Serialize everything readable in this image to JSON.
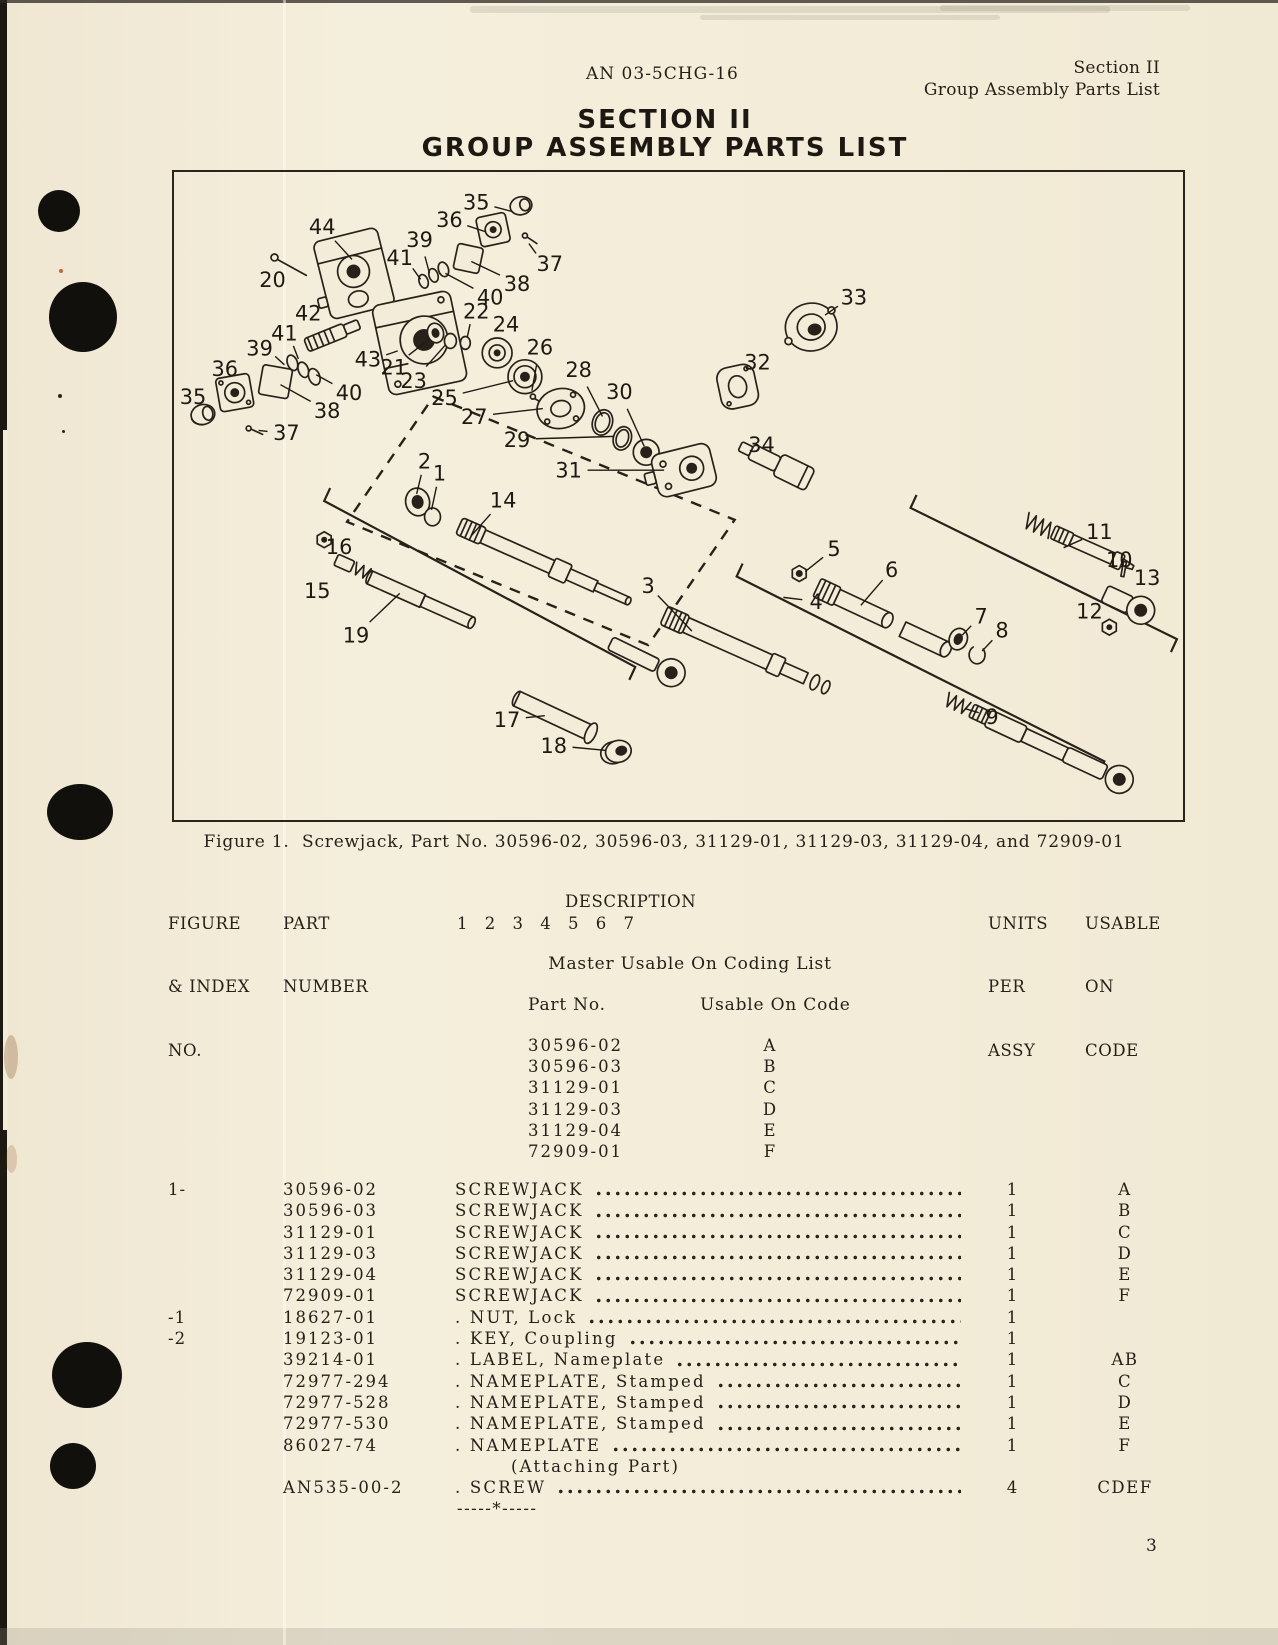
{
  "page": {
    "number": "3"
  },
  "header": {
    "doc_number": "AN 03-5CHG-16",
    "section": "Section II",
    "section_subtitle": "Group Assembly Parts List",
    "title_line1": "SECTION II",
    "title_line2": "GROUP ASSEMBLY PARTS LIST"
  },
  "figure": {
    "caption": "Figure 1.  Screwjack, Part No. 30596-02, 30596-03, 31129-01, 31129-03, 31129-04, and 72909-01",
    "callouts": [
      {
        "n": "35",
        "x": 303,
        "y": 30,
        "tx": 340,
        "ty": 40
      },
      {
        "n": "36",
        "x": 276,
        "y": 48,
        "tx": 312,
        "ty": 60
      },
      {
        "n": "44",
        "x": 148,
        "y": 55,
        "tx": 178,
        "ty": 88
      },
      {
        "n": "39",
        "x": 246,
        "y": 68,
        "tx": 256,
        "ty": 102
      },
      {
        "n": "41",
        "x": 226,
        "y": 86,
        "tx": 247,
        "ty": 108
      },
      {
        "n": "37",
        "x": 377,
        "y": 92,
        "tx": 356,
        "ty": 72
      },
      {
        "n": "20",
        "x": 98,
        "y": 108,
        "tx": 110,
        "ty": 94
      },
      {
        "n": "38",
        "x": 344,
        "y": 112,
        "tx": 298,
        "ty": 90
      },
      {
        "n": "40",
        "x": 317,
        "y": 126,
        "tx": 272,
        "ty": 102
      },
      {
        "n": "42",
        "x": 134,
        "y": 142,
        "tx": 150,
        "ty": 158
      },
      {
        "n": "22",
        "x": 303,
        "y": 140,
        "tx": 294,
        "ty": 166
      },
      {
        "n": "24",
        "x": 333,
        "y": 153,
        "tx": 327,
        "ty": 176
      },
      {
        "n": "41",
        "x": 110,
        "y": 162,
        "tx": 124,
        "ty": 188
      },
      {
        "n": "39",
        "x": 85,
        "y": 177,
        "tx": 110,
        "ty": 194
      },
      {
        "n": "26",
        "x": 367,
        "y": 176,
        "tx": 359,
        "ty": 220
      },
      {
        "n": "43",
        "x": 194,
        "y": 188,
        "tx": 224,
        "ty": 180
      },
      {
        "n": "21",
        "x": 220,
        "y": 196,
        "tx": 256,
        "ty": 168
      },
      {
        "n": "36",
        "x": 50,
        "y": 198,
        "tx": 58,
        "ty": 216
      },
      {
        "n": "28",
        "x": 406,
        "y": 199,
        "tx": 430,
        "ty": 246
      },
      {
        "n": "23",
        "x": 240,
        "y": 210,
        "tx": 272,
        "ty": 174
      },
      {
        "n": "40",
        "x": 175,
        "y": 222,
        "tx": 142,
        "ty": 204
      },
      {
        "n": "35",
        "x": 18,
        "y": 226,
        "tx": 27,
        "ty": 240
      },
      {
        "n": "25",
        "x": 271,
        "y": 227,
        "tx": 340,
        "ty": 210
      },
      {
        "n": "38",
        "x": 153,
        "y": 240,
        "tx": 106,
        "ty": 214
      },
      {
        "n": "27",
        "x": 301,
        "y": 246,
        "tx": 370,
        "ty": 238
      },
      {
        "n": "37",
        "x": 112,
        "y": 262,
        "tx": 84,
        "ty": 260
      },
      {
        "n": "29",
        "x": 344,
        "y": 269,
        "tx": 442,
        "ty": 266
      },
      {
        "n": "30",
        "x": 447,
        "y": 221,
        "tx": 472,
        "ty": 276
      },
      {
        "n": "31",
        "x": 396,
        "y": 300,
        "tx": 492,
        "ty": 300
      },
      {
        "n": "33",
        "x": 683,
        "y": 126,
        "tx": 654,
        "ty": 144
      },
      {
        "n": "32",
        "x": 586,
        "y": 191,
        "tx": 572,
        "ty": 210
      },
      {
        "n": "34",
        "x": 590,
        "y": 274,
        "tx": 606,
        "ty": 292
      },
      {
        "n": "2",
        "x": 251,
        "y": 291,
        "tx": 243,
        "ty": 324
      },
      {
        "n": "1",
        "x": 266,
        "y": 303,
        "tx": 258,
        "ty": 340
      },
      {
        "n": "14",
        "x": 330,
        "y": 330,
        "tx": 298,
        "ty": 366
      },
      {
        "n": "16",
        "x": 165,
        "y": 377,
        "tx": 153,
        "ty": 371
      },
      {
        "n": "15",
        "x": 143,
        "y": 421,
        "tx": 130,
        "ty": 400
      },
      {
        "n": "19",
        "x": 182,
        "y": 466,
        "tx": 226,
        "ty": 424
      },
      {
        "n": "3",
        "x": 476,
        "y": 416,
        "tx": 520,
        "ty": 462
      },
      {
        "n": "17",
        "x": 334,
        "y": 551,
        "tx": 372,
        "ty": 547
      },
      {
        "n": "18",
        "x": 381,
        "y": 577,
        "tx": 434,
        "ty": 582
      },
      {
        "n": "5",
        "x": 663,
        "y": 379,
        "tx": 634,
        "ty": 402
      },
      {
        "n": "6",
        "x": 721,
        "y": 400,
        "tx": 690,
        "ty": 436
      },
      {
        "n": "4",
        "x": 645,
        "y": 432,
        "tx": 612,
        "ty": 428
      },
      {
        "n": "7",
        "x": 811,
        "y": 447,
        "tx": 792,
        "ty": 466
      },
      {
        "n": "8",
        "x": 832,
        "y": 461,
        "tx": 812,
        "ty": 482
      },
      {
        "n": "9",
        "x": 822,
        "y": 548,
        "tx": 795,
        "ty": 540
      },
      {
        "n": "11",
        "x": 930,
        "y": 362,
        "tx": 894,
        "ty": 378
      },
      {
        "n": "10",
        "x": 950,
        "y": 390,
        "tx": 957,
        "ty": 400
      },
      {
        "n": "13",
        "x": 978,
        "y": 408,
        "tx": 966,
        "ty": 428
      },
      {
        "n": "12",
        "x": 920,
        "y": 442,
        "tx": 936,
        "ty": 456
      }
    ]
  },
  "table": {
    "col1": [
      "FIGURE",
      "& INDEX",
      "NO."
    ],
    "col2": [
      "PART",
      "NUMBER"
    ],
    "desc_label": "DESCRIPTION",
    "desc_numbers": "1 2 3 4 5 6 7",
    "units": [
      "UNITS",
      "PER",
      "ASSY"
    ],
    "usable": [
      "USABLE",
      "ON",
      "CODE"
    ]
  },
  "coding_list": {
    "title": "Master Usable On Coding List",
    "col_part": "Part No.",
    "col_code": "Usable On Code",
    "entries": [
      {
        "part": "30596-02",
        "code": "A"
      },
      {
        "part": "30596-03",
        "code": "B"
      },
      {
        "part": "31129-01",
        "code": "C"
      },
      {
        "part": "31129-03",
        "code": "D"
      },
      {
        "part": "31129-04",
        "code": "E"
      },
      {
        "part": "72909-01",
        "code": "F"
      }
    ]
  },
  "parts": [
    {
      "index": "1-",
      "part": "30596-02",
      "desc": "SCREWJACK",
      "leader": true,
      "units": "1",
      "code": "A"
    },
    {
      "index": "",
      "part": "30596-03",
      "desc": "SCREWJACK",
      "leader": true,
      "units": "1",
      "code": "B"
    },
    {
      "index": "",
      "part": "31129-01",
      "desc": "SCREWJACK",
      "leader": true,
      "units": "1",
      "code": "C"
    },
    {
      "index": "",
      "part": "31129-03",
      "desc": "SCREWJACK",
      "leader": true,
      "units": "1",
      "code": "D"
    },
    {
      "index": "",
      "part": "31129-04",
      "desc": "SCREWJACK",
      "leader": true,
      "units": "1",
      "code": "E"
    },
    {
      "index": "",
      "part": "72909-01",
      "desc": "SCREWJACK",
      "leader": true,
      "units": "1",
      "code": "F"
    },
    {
      "index": "-1",
      "part": "18627-01",
      "desc": ". NUT, Lock",
      "leader": true,
      "units": "1",
      "code": ""
    },
    {
      "index": "-2",
      "part": "19123-01",
      "desc": ". KEY, Coupling",
      "leader": true,
      "units": "1",
      "code": ""
    },
    {
      "index": "",
      "part": "39214-01",
      "desc": ". LABEL, Nameplate",
      "leader": true,
      "units": "1",
      "code": "AB"
    },
    {
      "index": "",
      "part": "72977-294",
      "desc": ". NAMEPLATE, Stamped",
      "leader": true,
      "units": "1",
      "code": "C"
    },
    {
      "index": "",
      "part": "72977-528",
      "desc": ". NAMEPLATE, Stamped",
      "leader": true,
      "units": "1",
      "code": "D"
    },
    {
      "index": "",
      "part": "72977-530",
      "desc": ". NAMEPLATE, Stamped",
      "leader": true,
      "units": "1",
      "code": "E"
    },
    {
      "index": "",
      "part": "86027-74",
      "desc": ". NAMEPLATE",
      "leader": true,
      "units": "1",
      "code": "F"
    },
    {
      "index": "",
      "part": "",
      "desc": "(Attaching Part)",
      "indent": true,
      "units": "",
      "code": ""
    },
    {
      "index": "",
      "part": "AN535-00-2",
      "desc": ". SCREW",
      "leader": true,
      "units": "4",
      "code": "CDEF"
    },
    {
      "index": "",
      "part": "",
      "desc": "-----*-----",
      "separator": true,
      "units": "",
      "code": ""
    }
  ]
}
